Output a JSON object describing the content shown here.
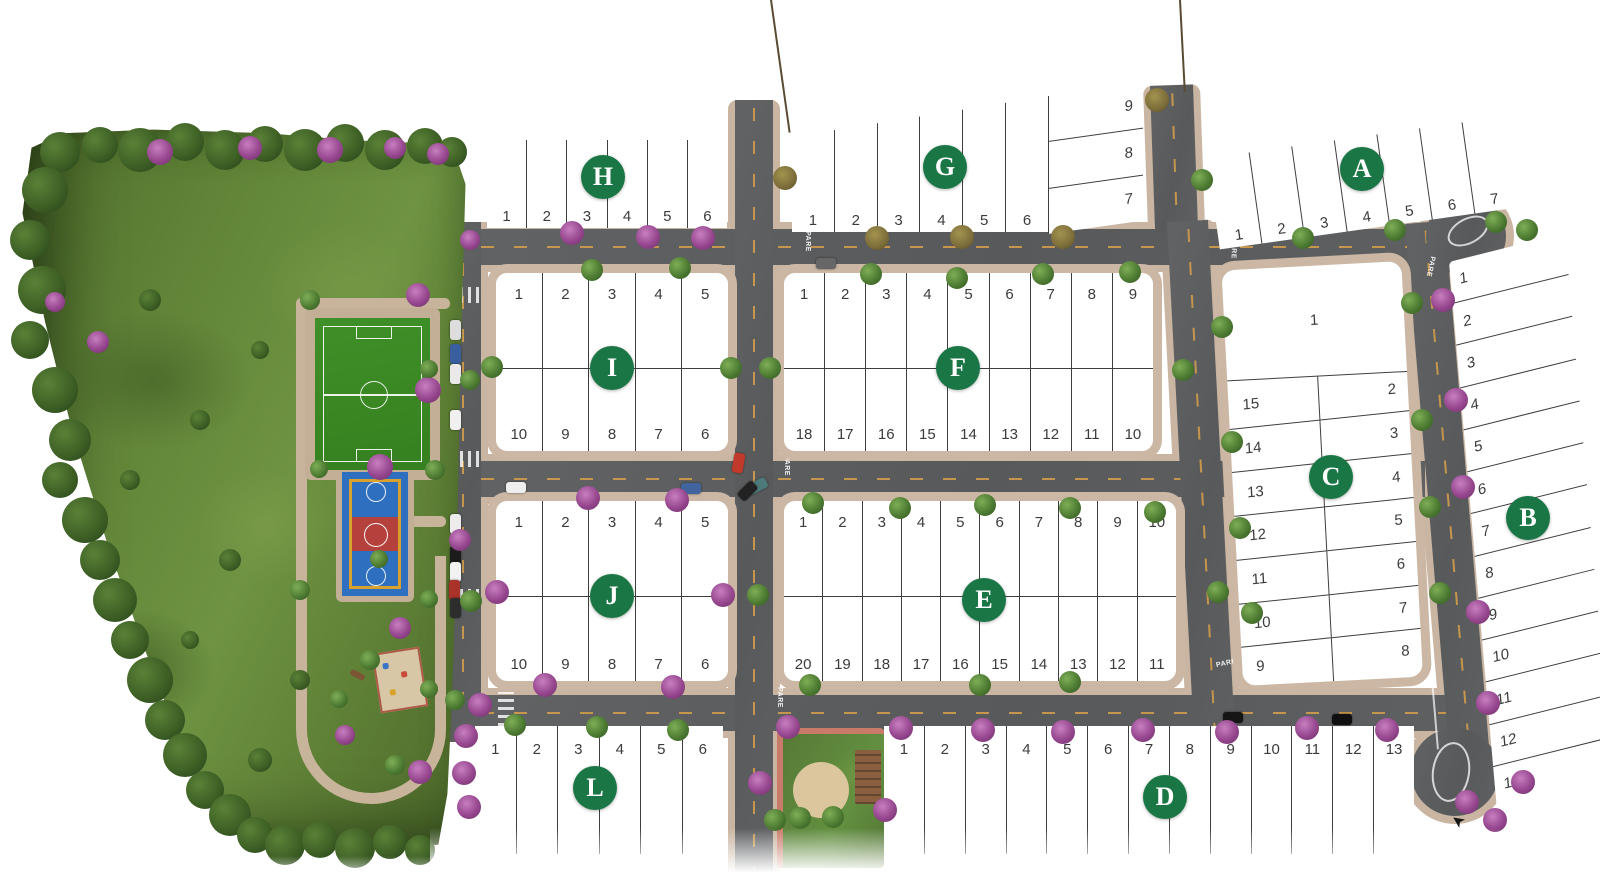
{
  "markings": {
    "stop_text": "PARE"
  },
  "colors": {
    "badge_green": "#1a7745",
    "asphalt": "#5d5f61",
    "sidewalk": "#c9b5a1",
    "park_grass": "#64883a",
    "field_green": "#3b8b27",
    "court_blue": "#2e6fc0",
    "court_red": "#b5413c",
    "court_yellow": "#d8a22c",
    "tree_green": "#4e7c33",
    "tree_purple": "#97478f",
    "dash_yellow": "#d8a048",
    "lot_line": "#3e3e3e"
  },
  "blocks": [
    {
      "label": "H",
      "lots": [
        "1",
        "2",
        "3",
        "4",
        "5",
        "6"
      ]
    },
    {
      "label": "G",
      "lots": [
        "1",
        "2",
        "3",
        "4",
        "5",
        "6"
      ],
      "side_lots": [
        "9",
        "8",
        "7"
      ]
    },
    {
      "label": "A",
      "lots": [
        "1",
        "2",
        "3",
        "4",
        "5",
        "6",
        "7"
      ]
    },
    {
      "label": "I",
      "lots_top": [
        "1",
        "2",
        "3",
        "4",
        "5"
      ],
      "lots_bottom": [
        "10",
        "9",
        "8",
        "7",
        "6"
      ]
    },
    {
      "label": "F",
      "lots_top": [
        "1",
        "2",
        "3",
        "4",
        "5",
        "6",
        "7",
        "8",
        "9"
      ],
      "lots_bottom": [
        "18",
        "17",
        "16",
        "15",
        "14",
        "13",
        "12",
        "11",
        "10"
      ]
    },
    {
      "label": "C",
      "lot_feature": "1",
      "lots_left": [
        "15",
        "14",
        "13",
        "12",
        "11",
        "10",
        "9"
      ],
      "lots_right": [
        "2",
        "3",
        "4",
        "5",
        "6",
        "7",
        "8"
      ]
    },
    {
      "label": "B",
      "lots": [
        "1",
        "2",
        "3",
        "4",
        "5",
        "6",
        "7",
        "8",
        "9",
        "10",
        "11",
        "12",
        "13"
      ]
    },
    {
      "label": "J",
      "lots_top": [
        "1",
        "2",
        "3",
        "4",
        "5"
      ],
      "lots_bottom": [
        "10",
        "9",
        "8",
        "7",
        "6"
      ]
    },
    {
      "label": "E",
      "lots_top": [
        "1",
        "2",
        "3",
        "4",
        "5",
        "6",
        "7",
        "8",
        "9",
        "10"
      ],
      "lots_bottom": [
        "20",
        "19",
        "18",
        "17",
        "16",
        "15",
        "14",
        "13",
        "12",
        "11"
      ]
    },
    {
      "label": "L",
      "lots": [
        "1",
        "2",
        "3",
        "4",
        "5",
        "6"
      ]
    },
    {
      "label": "D",
      "lots": [
        "1",
        "2",
        "3",
        "4",
        "5",
        "6",
        "7",
        "8",
        "9",
        "10",
        "11",
        "12",
        "13"
      ]
    }
  ]
}
